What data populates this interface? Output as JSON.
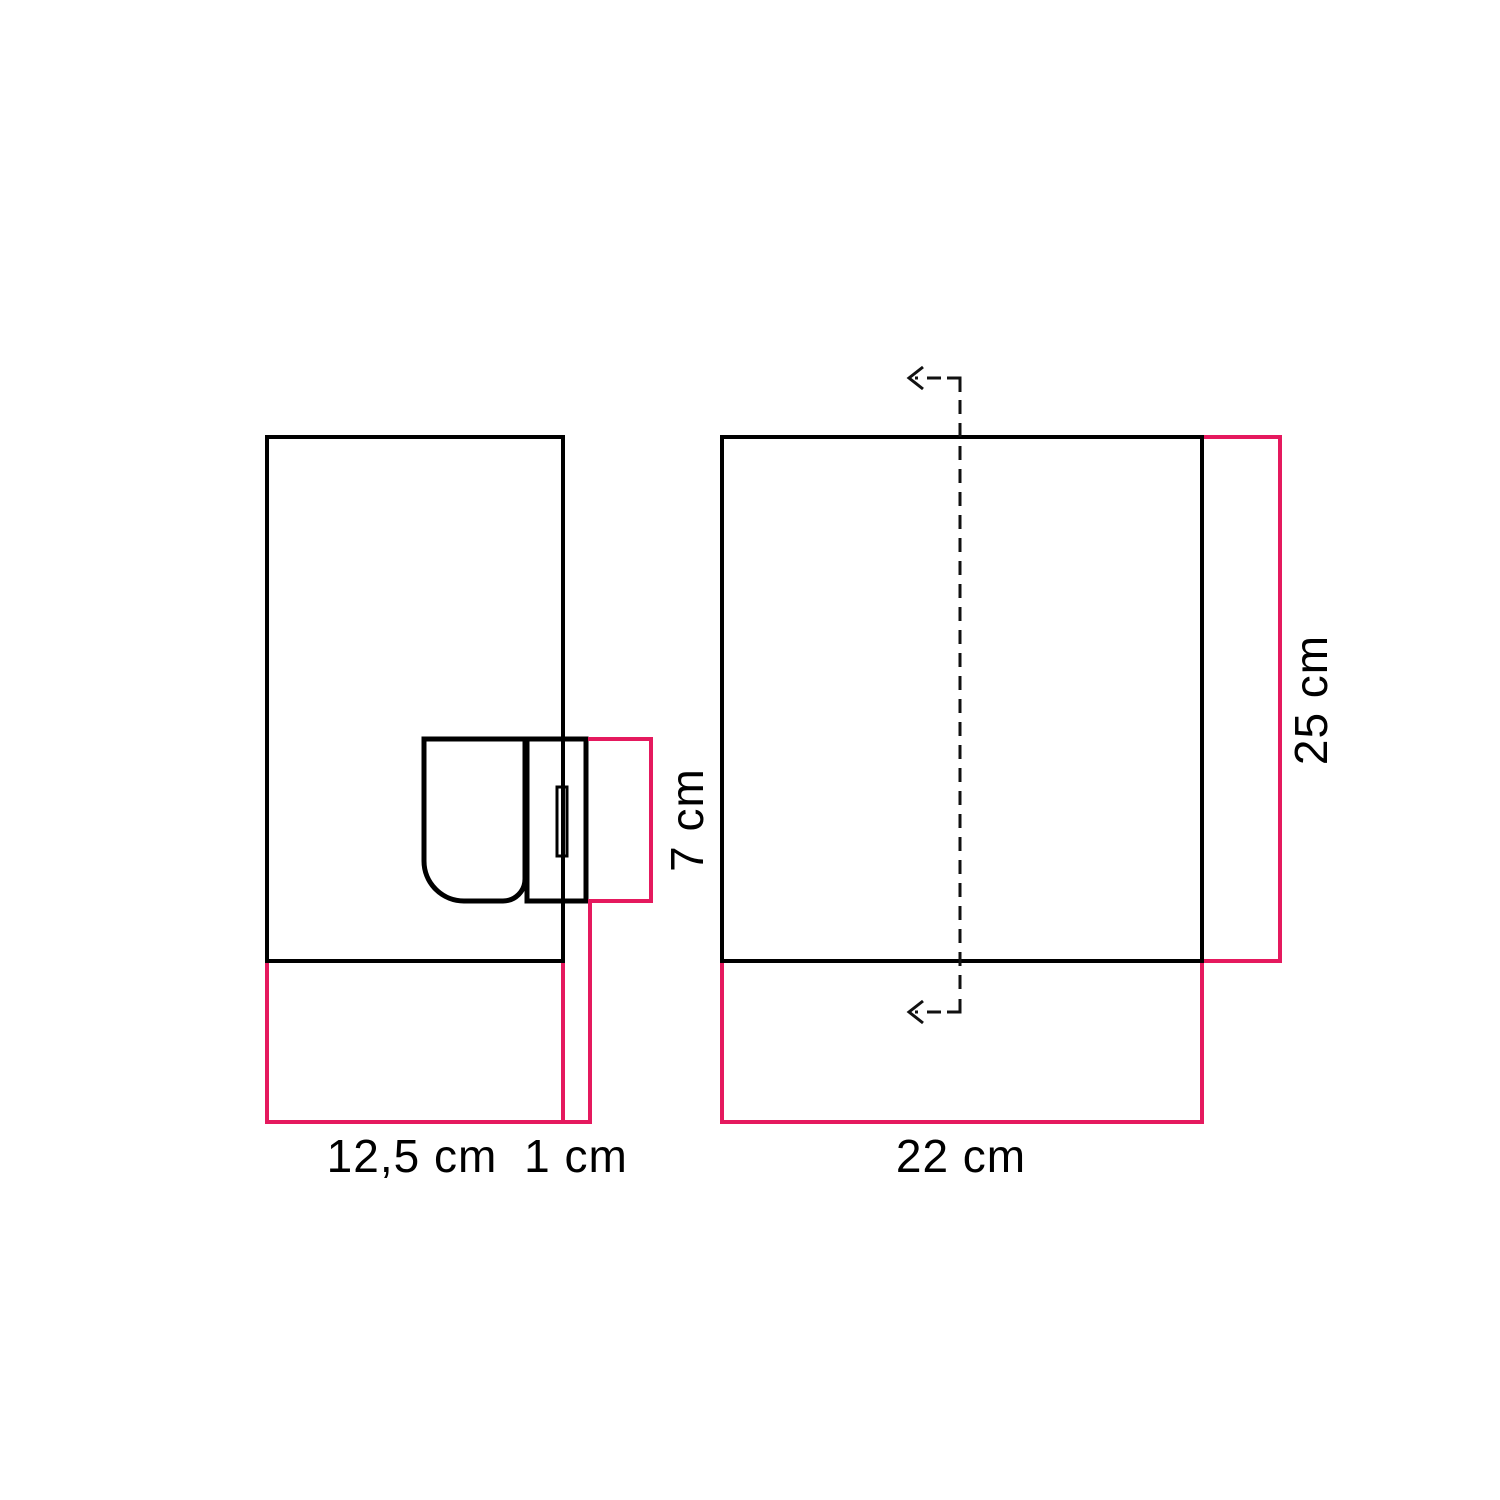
{
  "diagram": {
    "kind": "product-dimension-drawing",
    "background": "#ffffff"
  },
  "colors": {
    "outline": "#000000",
    "dimension_accent": "#e5195e",
    "label_text": "#000000"
  },
  "views": {
    "side": {
      "dimensions": {
        "shade_width": {
          "label": "12,5 cm"
        },
        "mount_depth": {
          "label": "1 cm"
        },
        "mount_height": {
          "label": "7 cm"
        }
      }
    },
    "front": {
      "dimensions": {
        "width": {
          "label": "22 cm"
        },
        "height": {
          "label": "25 cm"
        }
      }
    }
  }
}
